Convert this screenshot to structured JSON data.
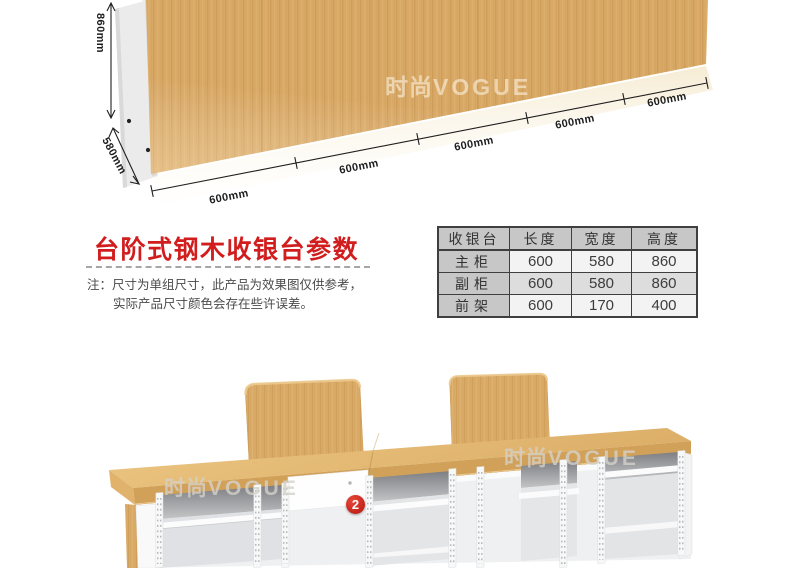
{
  "watermark": {
    "brand_cn": "时尚",
    "brand_en": "VOGUE"
  },
  "top_figure": {
    "height_label": "860mm",
    "depth_label": "580mm",
    "width_labels": [
      "600mm",
      "600mm",
      "600mm",
      "600mm",
      "600mm"
    ]
  },
  "params_section": {
    "title": "台阶式钢木收银台参数",
    "note_prefix": "注：",
    "note_line1": "尺寸为单组尺寸，此产品为效果图仅供参考，",
    "note_line2": "实际产品尺寸颜色会存在些许误差。"
  },
  "spec_table": {
    "headers": [
      "收银台",
      "长度",
      "宽度",
      "高度"
    ],
    "rows": [
      [
        "主柜",
        "600",
        "580",
        "860"
      ],
      [
        "副柜",
        "600",
        "580",
        "860"
      ],
      [
        "前架",
        "600",
        "170",
        "400"
      ]
    ]
  },
  "bottom_figure": {
    "step_badge": "2"
  },
  "colors": {
    "title_red": "#d11d1d",
    "badge_red": "#c5231f",
    "wood": "#d8a865",
    "table_header_bg": "#c7c7c7"
  }
}
